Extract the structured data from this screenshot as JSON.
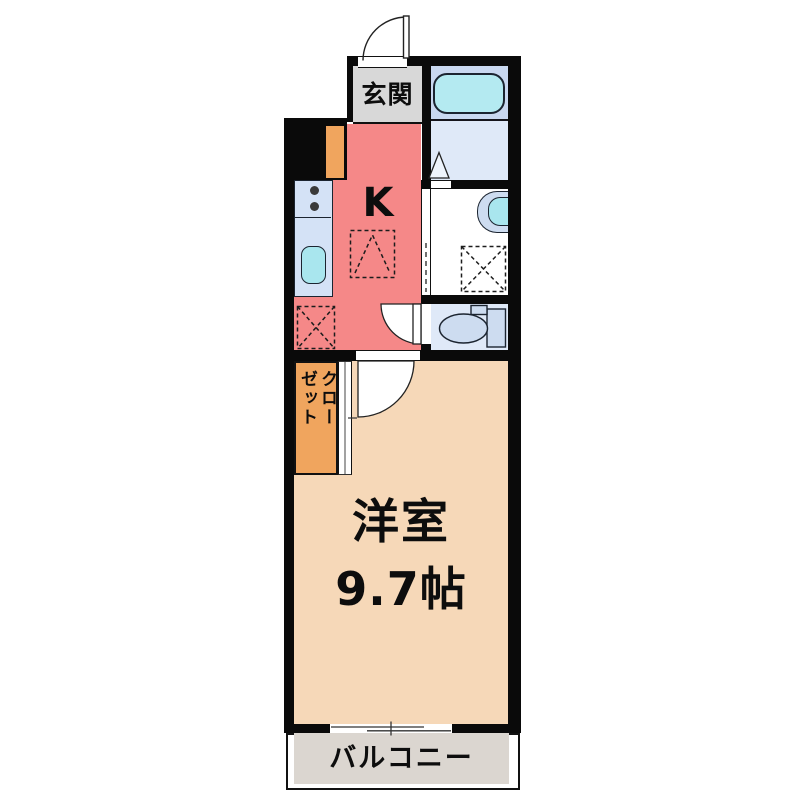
{
  "plan": {
    "title": "1K apartment floor plan",
    "entrance": {
      "label": "玄関"
    },
    "kitchen": {
      "label": "K"
    },
    "main_room": {
      "name": "洋室",
      "size": "9.7帖"
    },
    "closet": {
      "line1": "クロー",
      "line2": "ゼット"
    },
    "balcony": {
      "label": "バルコニー"
    },
    "fixtures": {
      "entrance_door": "hinged-door-arc",
      "bathtub": "bathtub",
      "bathroom_door": "triangle-door-mark",
      "wash_basin": "wash-basin",
      "washing_machine_space": "dashed-square-x",
      "refrigerator_space": "dashed-square-x",
      "kitchen_reserved_space": "dashed-square-caret",
      "toilet": "toilet",
      "stove": "two-burner-stove",
      "kitchen_sink": "sink",
      "closet_doors": "sliding-panels",
      "balcony_window": "sliding-window",
      "washroom_door": "sliding-door-dashed"
    },
    "colors": {
      "kitchen": "#f58888",
      "genkan": "#d8d8d8",
      "room": "#f6d8b8",
      "balcony": "#dbd6d0",
      "closet": "#f0a55e",
      "bathzone": "#c9d8f0",
      "bathfloor": "#dfe9f8",
      "counter": "#d4e2f6",
      "tub": "#b4eaf1",
      "sink": "#a9e6ee",
      "fixture": "#cddcf0",
      "wall": "#0a0a0a"
    }
  }
}
